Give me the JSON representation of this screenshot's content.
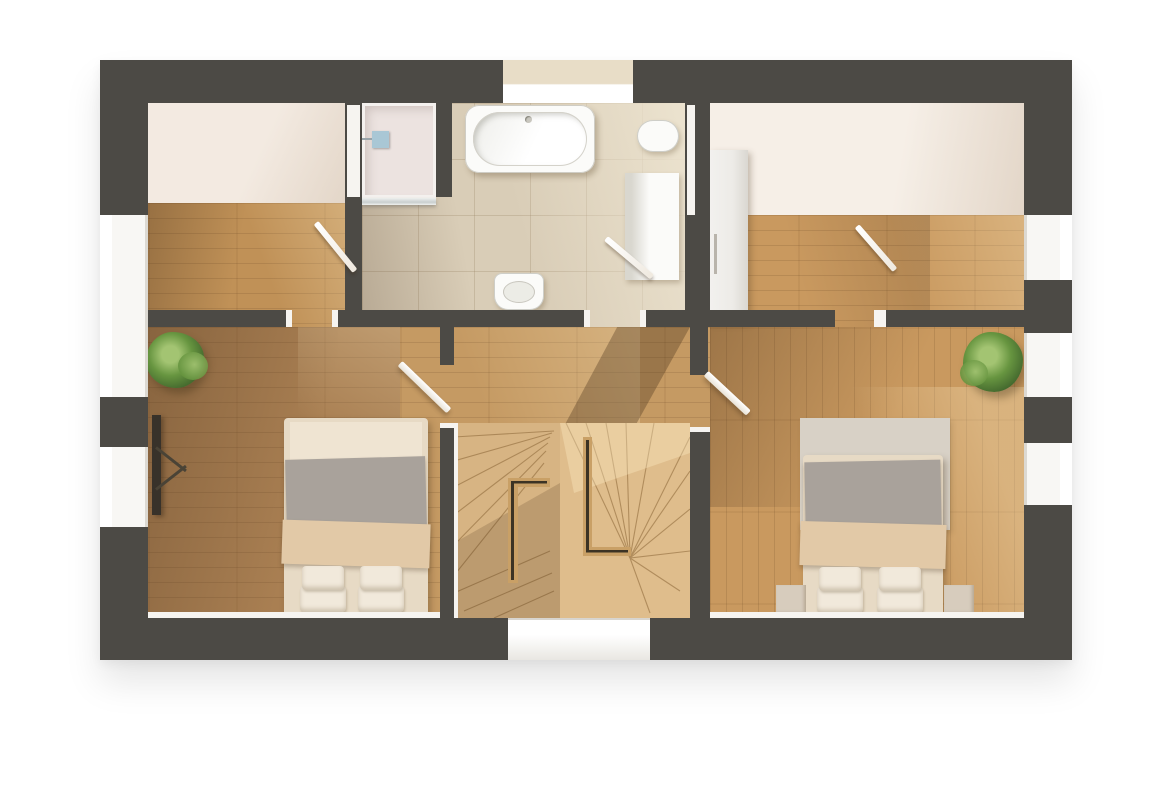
{
  "scene": {
    "type": "3d-rendered-floor-plan",
    "view": "top-down",
    "style": "photorealistic render with diagonal sunlight"
  },
  "colors": {
    "wall": "#4c4a45",
    "wallDeep": "#43413d",
    "trim": "#f6f4f0",
    "white": "#ffffff",
    "cream": "#f3eae1",
    "creamShade": "#e3d6c8",
    "woodTopLeft": "#c09157",
    "woodBedLeft": "#a97f52",
    "woodBedRight": "#c9995f",
    "woodHall": "#c59a63",
    "stairWood": "#dfbd8c",
    "stairRail": "#c9a066",
    "tile": "#d9cdb7",
    "tileLight": "#ece3cf",
    "fixture": "#fbfbf9",
    "fixtureShade": "#d9d7cf",
    "showerTray": "#ece3e0",
    "showerBlue": "#a9c7d5",
    "bedFrame": "#e7dac5",
    "duvet": "#a9a29b",
    "blanket": "#e2c9a7",
    "pillow": "#f1e9db",
    "rug": "#d8d1c6",
    "nightstand": "#d7ccbd",
    "wardrobe": "#edebe7",
    "tv": "#38322a",
    "plant": "#679540",
    "plantDark": "#40642c",
    "plantLight": "#a3c472",
    "shadow": "rgba(66,43,23,0.32)",
    "sunlight": "rgba(255,238,198,0.30)"
  },
  "rooms": [
    {
      "id": "bedroom-left",
      "floor": "wood-plank"
    },
    {
      "id": "bedroom-right",
      "floor": "wood-plank"
    },
    {
      "id": "room-top-left",
      "floor": "wood-plank",
      "feature": "sloped-ceiling-area"
    },
    {
      "id": "room-top-right",
      "floor": "wood-plank",
      "feature": "sloped-ceiling-area"
    },
    {
      "id": "bathroom",
      "floor": "stone-tile"
    },
    {
      "id": "landing-stairwell",
      "floor": "wood-plank"
    }
  ],
  "stairs": {
    "type": "winder-staircase",
    "flights": 2,
    "rails": "L-shaped half walls"
  },
  "furniture": [
    "double-bed-left",
    "double-bed-right",
    "nightstand-left",
    "nightstand-right",
    "rug",
    "wardrobe",
    "tv-panel",
    "potted-plant-left",
    "potted-plant-right"
  ],
  "bathroom_fixtures": [
    "bathtub",
    "shower-enclosure",
    "shower-head",
    "washbasin",
    "bidet",
    "tall-cabinet"
  ],
  "openings": {
    "doors": [
      "door-room-top-left",
      "door-bathroom",
      "door-room-top-right",
      "doorway-bedroom-left",
      "doorway-bedroom-right"
    ],
    "windows": [
      "window-top-wall",
      "window-bottom-wall",
      "windows-left-wall",
      "windows-right-wall"
    ]
  }
}
